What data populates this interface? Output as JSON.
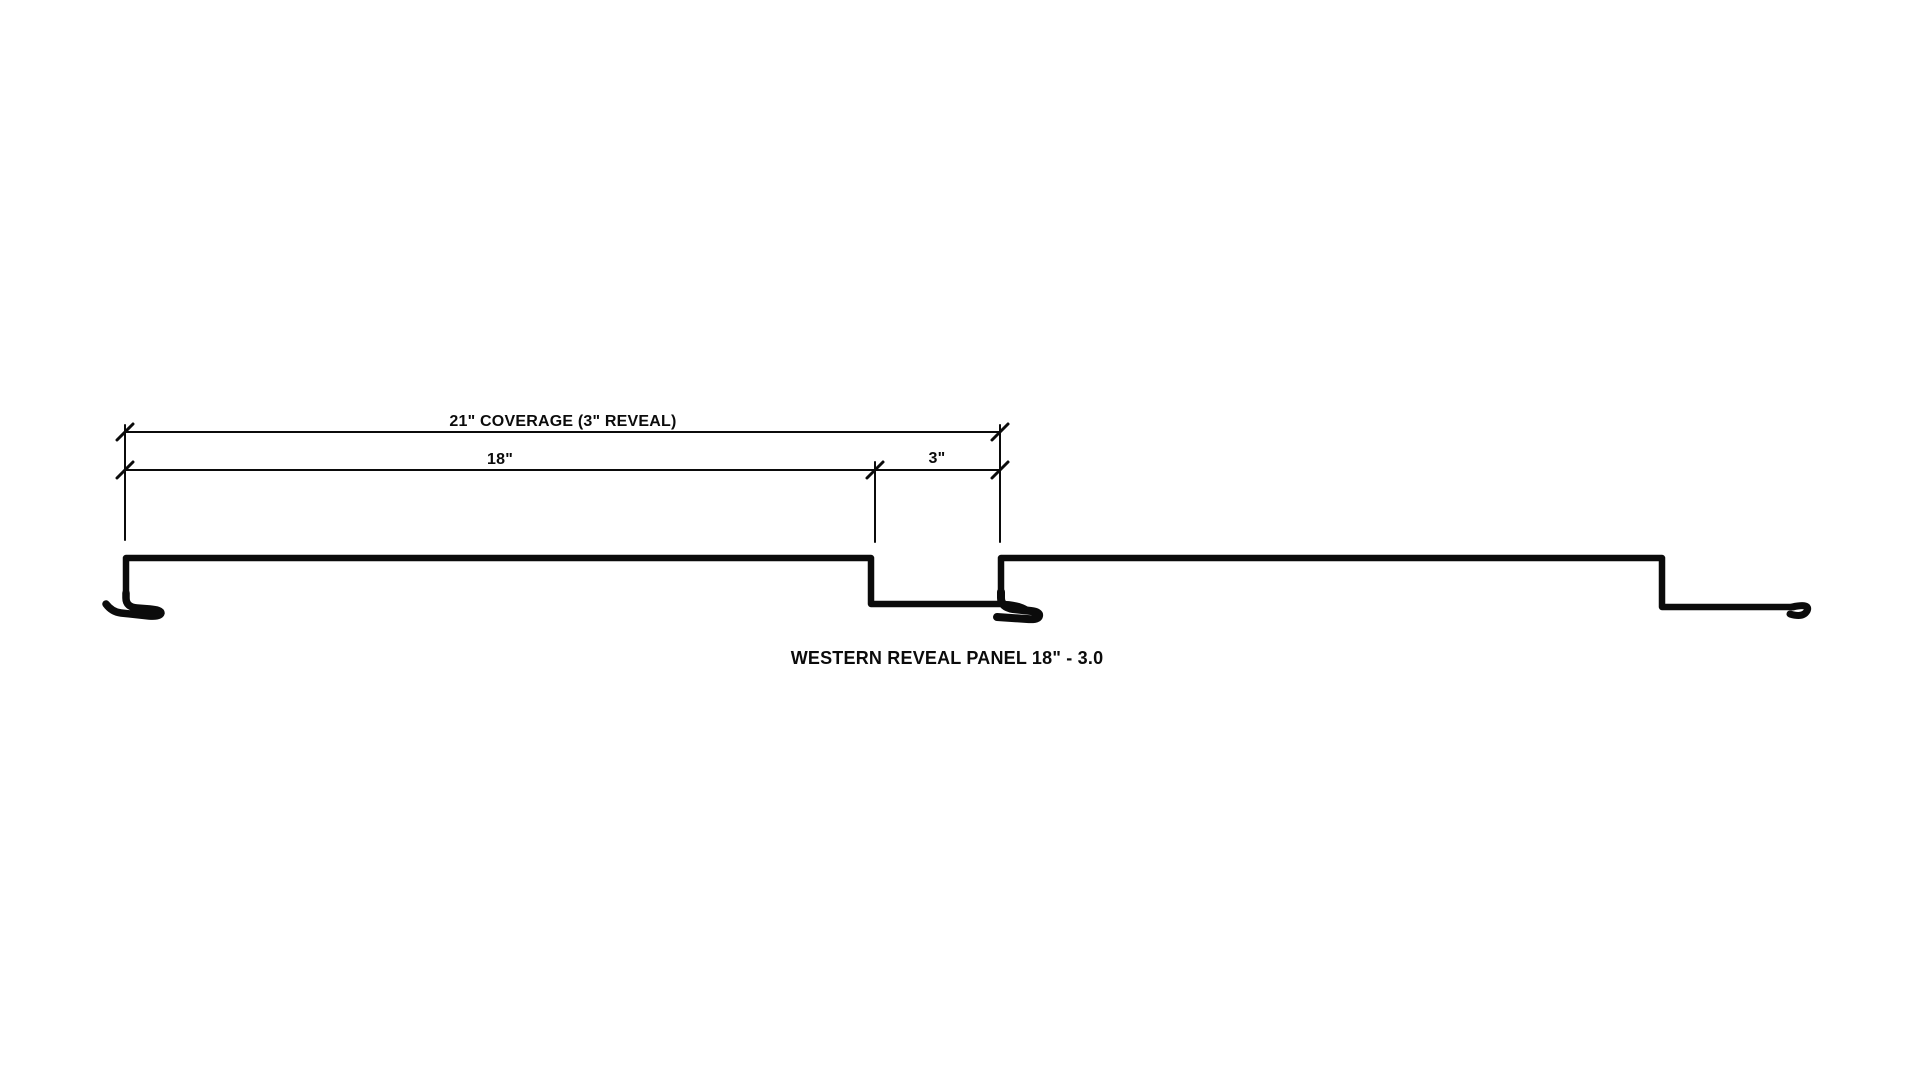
{
  "page": {
    "background_color": "#ffffff"
  },
  "drawing": {
    "line_color": "#0b0b0b",
    "caption": "WESTERN REVEAL PANEL 18\" - 3.0",
    "labels": {
      "coverage": "21\" COVERAGE (3\" REVEAL)",
      "panel_width": "18\"",
      "reveal": "3\""
    }
  }
}
